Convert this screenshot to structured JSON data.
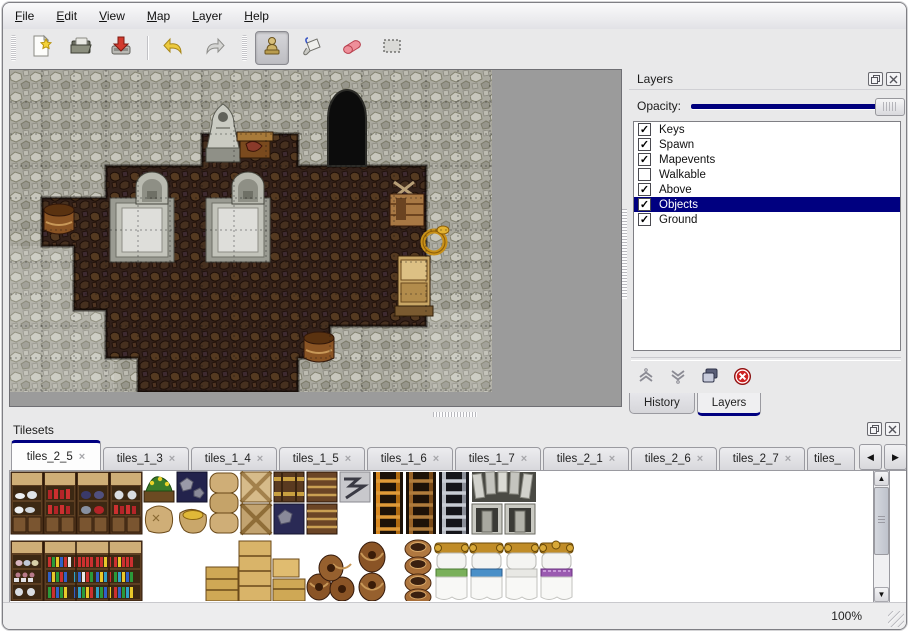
{
  "menu_bar": {
    "items": [
      {
        "label": "File"
      },
      {
        "label": "Edit"
      },
      {
        "label": "View"
      },
      {
        "label": "Map"
      },
      {
        "label": "Layer"
      },
      {
        "label": "Help"
      }
    ]
  },
  "toolbar": {
    "buttons": [
      {
        "name": "new"
      },
      {
        "name": "open"
      },
      {
        "name": "save"
      },
      {
        "name": "undo"
      },
      {
        "name": "redo"
      },
      {
        "name": "stamp",
        "active": true
      },
      {
        "name": "fill"
      },
      {
        "name": "eraser"
      },
      {
        "name": "rect-select"
      }
    ]
  },
  "layers_panel": {
    "title": "Layers",
    "opacity_label": "Opacity:",
    "opacity_at_max": true,
    "layers": [
      {
        "name": "Keys",
        "checked": true,
        "selected": false
      },
      {
        "name": "Spawn",
        "checked": true,
        "selected": false
      },
      {
        "name": "Mapevents",
        "checked": true,
        "selected": false
      },
      {
        "name": "Walkable",
        "checked": false,
        "selected": false
      },
      {
        "name": "Above",
        "checked": true,
        "selected": false
      },
      {
        "name": "Objects",
        "checked": true,
        "selected": true
      },
      {
        "name": "Ground",
        "checked": true,
        "selected": false
      }
    ],
    "tabs": [
      {
        "label": "History",
        "active": false
      },
      {
        "label": "Layers",
        "active": true
      }
    ]
  },
  "tilesets_panel": {
    "title": "Tilesets",
    "tabs": [
      {
        "label": "tiles_2_5",
        "active": true
      },
      {
        "label": "tiles_1_3",
        "active": false
      },
      {
        "label": "tiles_1_4",
        "active": false
      },
      {
        "label": "tiles_1_5",
        "active": false
      },
      {
        "label": "tiles_1_6",
        "active": false
      },
      {
        "label": "tiles_1_7",
        "active": false
      },
      {
        "label": "tiles_2_1",
        "active": false
      },
      {
        "label": "tiles_2_6",
        "active": false
      },
      {
        "label": "tiles_2_7",
        "active": false
      },
      {
        "label": "tiles_",
        "active": false
      }
    ]
  },
  "status_bar": {
    "zoom": "100%"
  },
  "icons": {
    "check": "✓",
    "close": "×",
    "tab_close": "×",
    "scroll_left": "◀",
    "scroll_right": "▶",
    "scroll_up": "▲",
    "scroll_down": "▼"
  }
}
